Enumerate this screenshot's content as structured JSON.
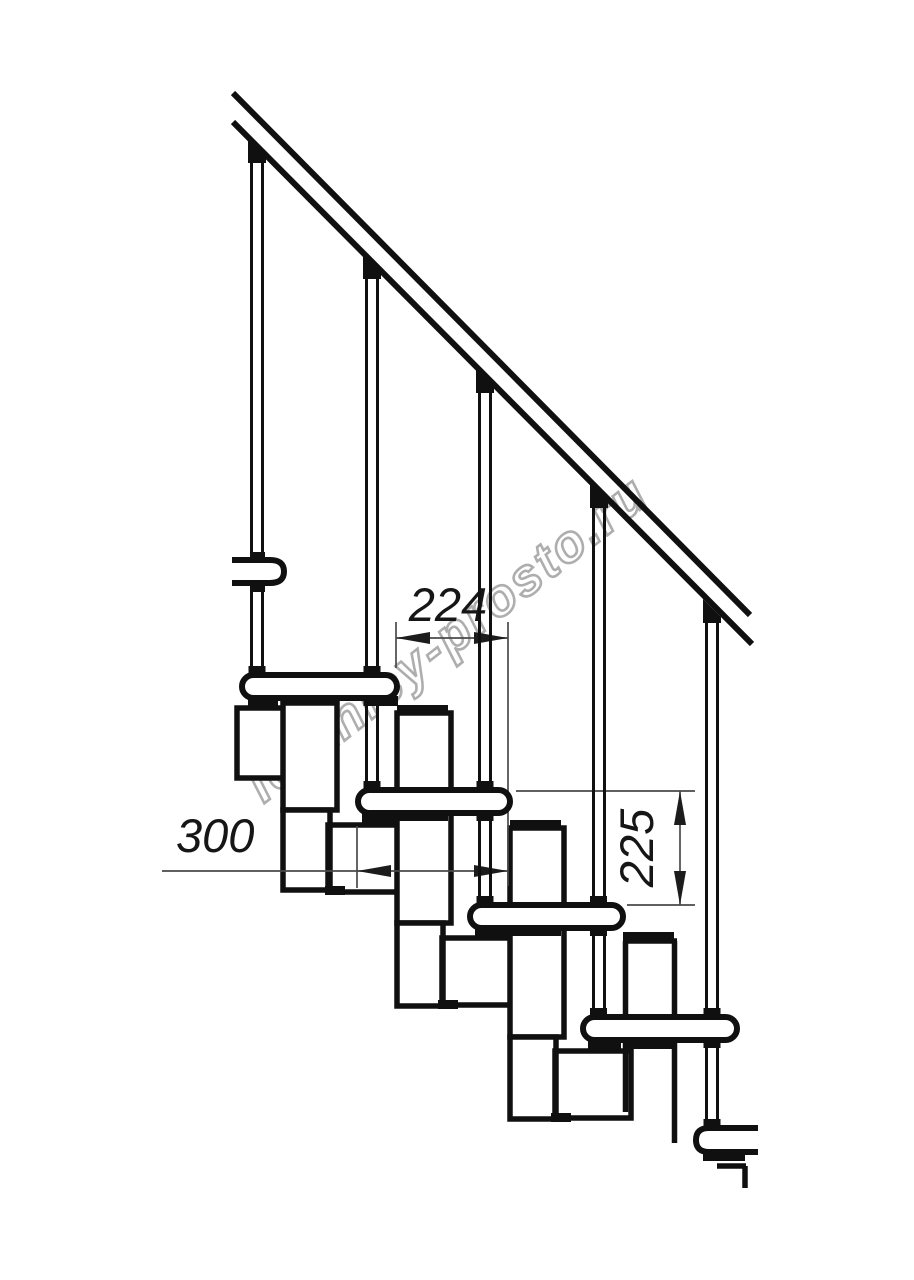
{
  "page": {
    "background_color": "#ffffff"
  },
  "drawing": {
    "kind": "staircase side elevation",
    "line_color": "#101010",
    "dimension_line_color": "#4a4a4a",
    "dimension_arrow_color": "#1c1c1c",
    "dimensions": {
      "step_run": {
        "label": "224",
        "orientation": "horizontal"
      },
      "tread_depth": {
        "label": "300",
        "orientation": "horizontal"
      },
      "riser_height": {
        "label": "225",
        "orientation": "vertical"
      }
    },
    "watermark": {
      "text": "lestnicy-prosto.ru",
      "color": "#a0a0a0"
    }
  }
}
